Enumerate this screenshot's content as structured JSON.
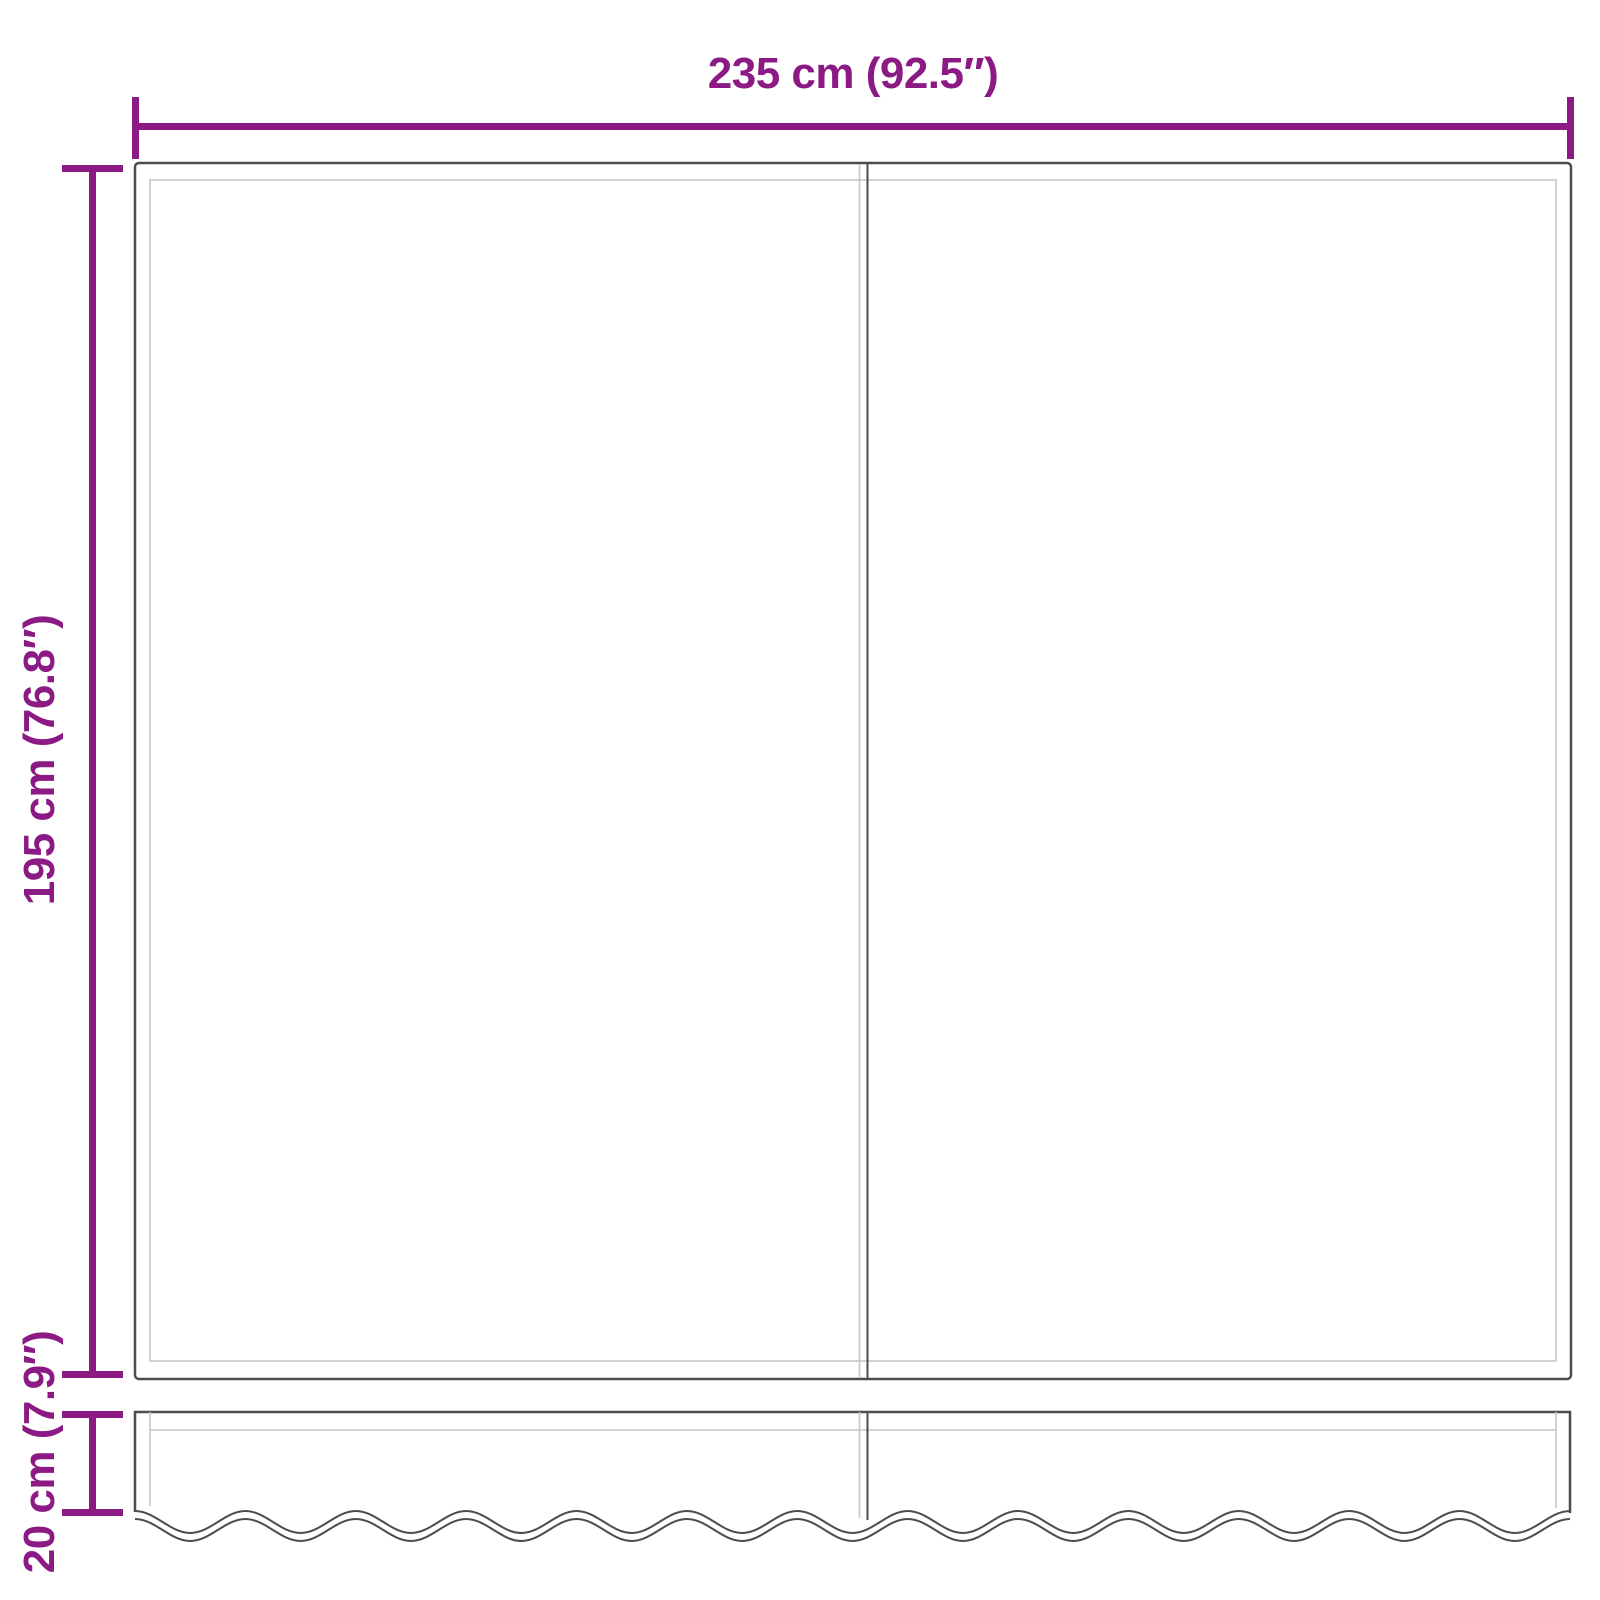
{
  "diagram": {
    "dimensions": {
      "width_label": "235 cm (92.5″)",
      "height_label": "195 cm (76.8″)",
      "valance_height_label": "20 cm (7.9″)"
    },
    "colors": {
      "dimension_accent": "#8B1A84",
      "outline_dark": "#4D4D4D",
      "outline_light": "#C6C6C6",
      "background": "#FFFFFF"
    }
  }
}
